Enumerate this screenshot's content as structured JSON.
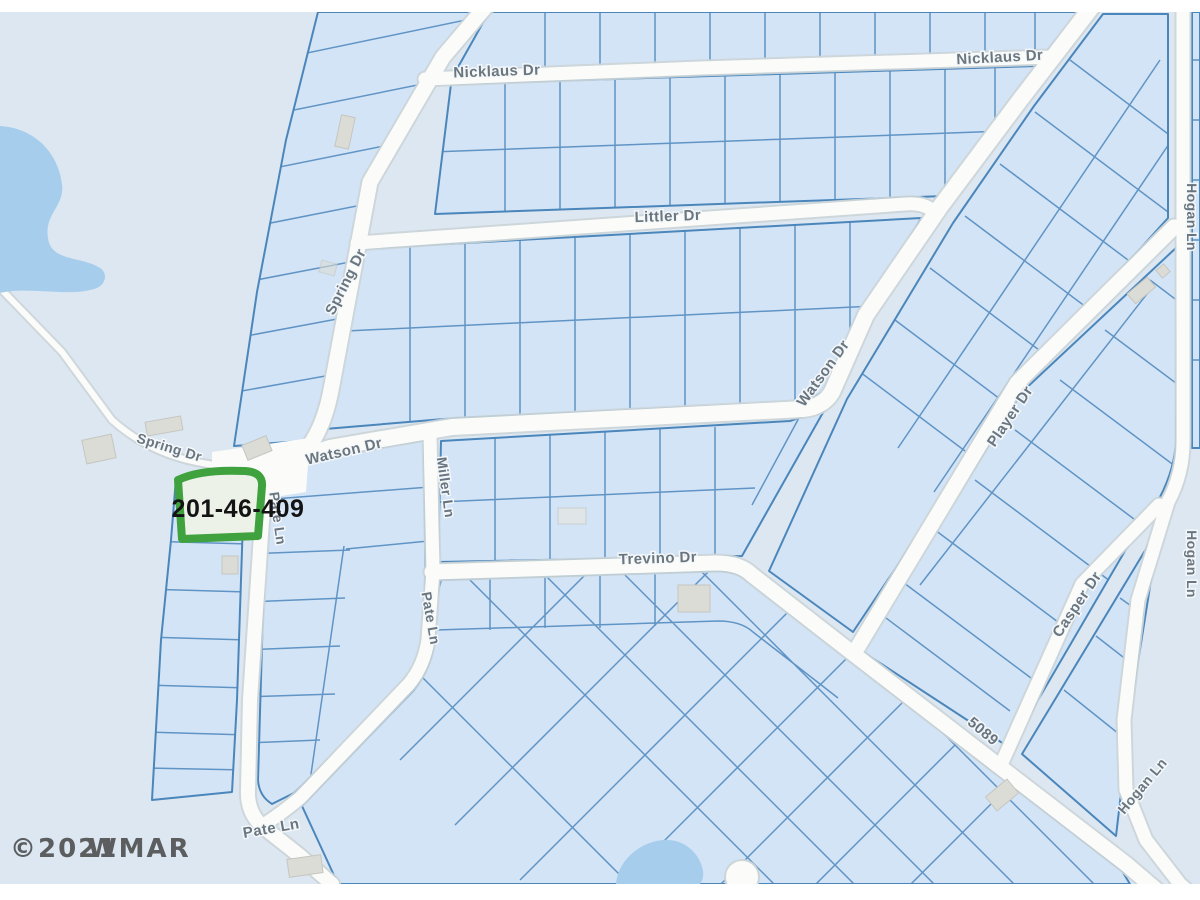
{
  "map": {
    "parcel_highlight": {
      "apn": "201-46-409"
    },
    "street_labels": {
      "nicklaus_w": "Nicklaus Dr",
      "nicklaus_e": "Nicklaus Dr",
      "littler": "Littler Dr",
      "watson_h": "Watson Dr",
      "watson_diag": "Watson Dr",
      "spring_diag": "Spring Dr",
      "spring_w": "Spring Dr",
      "pate_center": "Pate Ln",
      "miller": "Miller Ln",
      "pate_east": "Pate Ln",
      "pate_south": "Pate Ln",
      "trevino": "Trevino Dr",
      "player": "Player Dr",
      "casper": "Casper Dr",
      "hogan_top": "Hogan Ln",
      "hogan_mid": "Hogan Ln",
      "hogan_south": "Hogan Ln",
      "route_5089": "5089"
    },
    "watermark": {
      "year": "©2021",
      "name": "WMAR"
    },
    "colors": {
      "background": "#dce7f2",
      "parcel_fill": "#d3e4f7",
      "parcel_line": "#4b86bb",
      "street": "#fbfcf9",
      "street_casing": "#ccd5d8",
      "water": "#a7cded",
      "highlight_green": "#3fa23f",
      "highlight_fill": "#edf2e9",
      "label_gray": "#64707a",
      "apn_text": "#141414",
      "watermark_text": "#3b3b3b"
    }
  }
}
